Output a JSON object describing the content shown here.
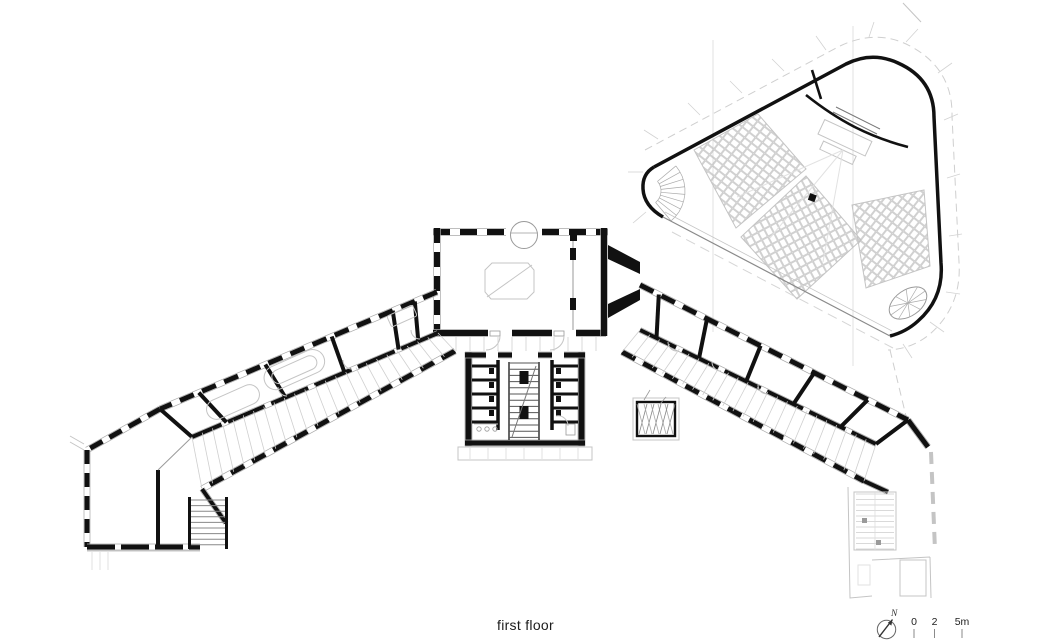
{
  "title": "first floor",
  "north": {
    "label": "N",
    "icon": "compass-needle"
  },
  "scale_bar": {
    "labels": [
      "0",
      "2",
      "5m"
    ],
    "unit": "m"
  },
  "colors": {
    "background": "#ffffff",
    "wall": "#111111",
    "mid_gray": "#9a9a9a",
    "light_gray": "#c4c4c4",
    "faint_gray": "#e2e2e2"
  }
}
